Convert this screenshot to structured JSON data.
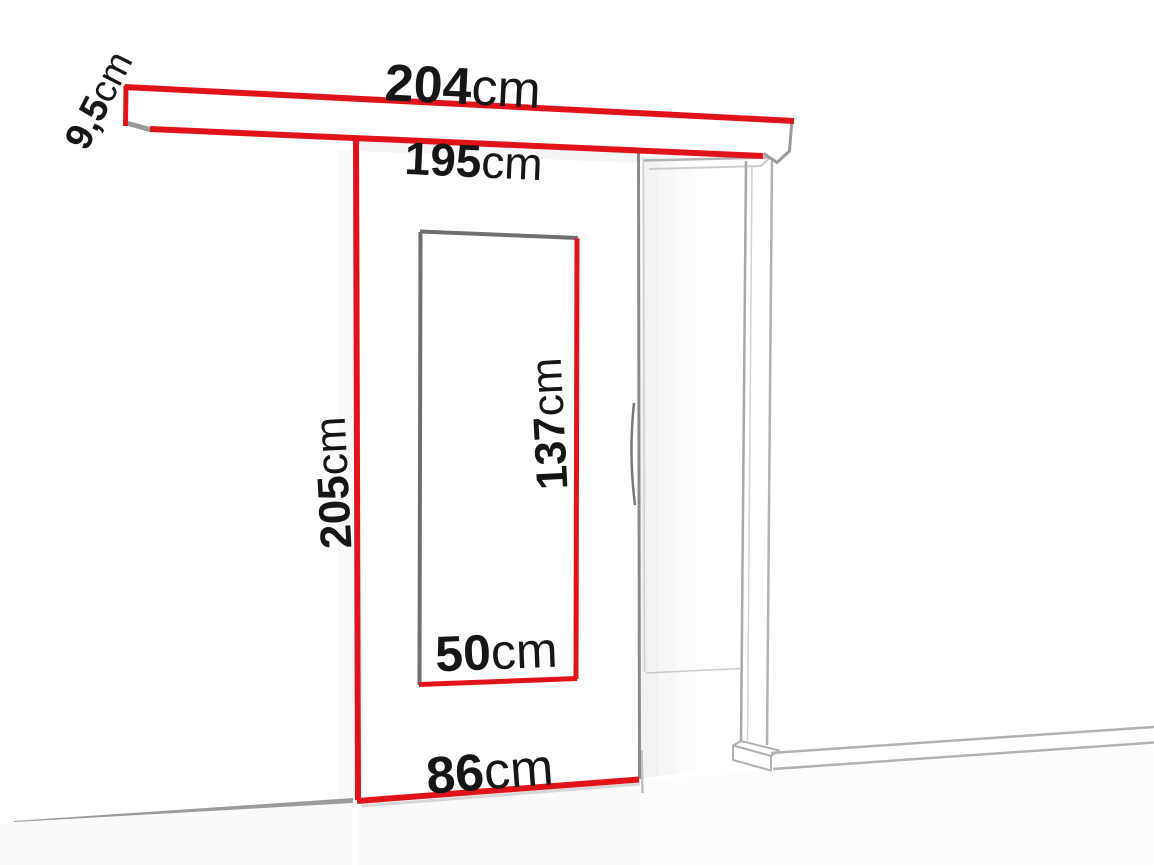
{
  "diagram": {
    "type": "sliding-door-dimension-diagram",
    "labels": {
      "rail_length": {
        "value": "204",
        "unit": "cm"
      },
      "rail_height": {
        "value": "9,5",
        "unit": "cm"
      },
      "passage_width": {
        "value": "195",
        "unit": "cm"
      },
      "door_height": {
        "value": "205",
        "unit": "cm"
      },
      "glass_height": {
        "value": "137",
        "unit": "cm"
      },
      "glass_width": {
        "value": "50",
        "unit": "cm"
      },
      "door_width": {
        "value": "86",
        "unit": "cm"
      }
    },
    "colors": {
      "dimension_red": "#e2121a",
      "edge_gray": "#8a8a8a",
      "frame_gray": "#b2b2b2",
      "text": "#161616",
      "background": "#ffffff"
    }
  }
}
